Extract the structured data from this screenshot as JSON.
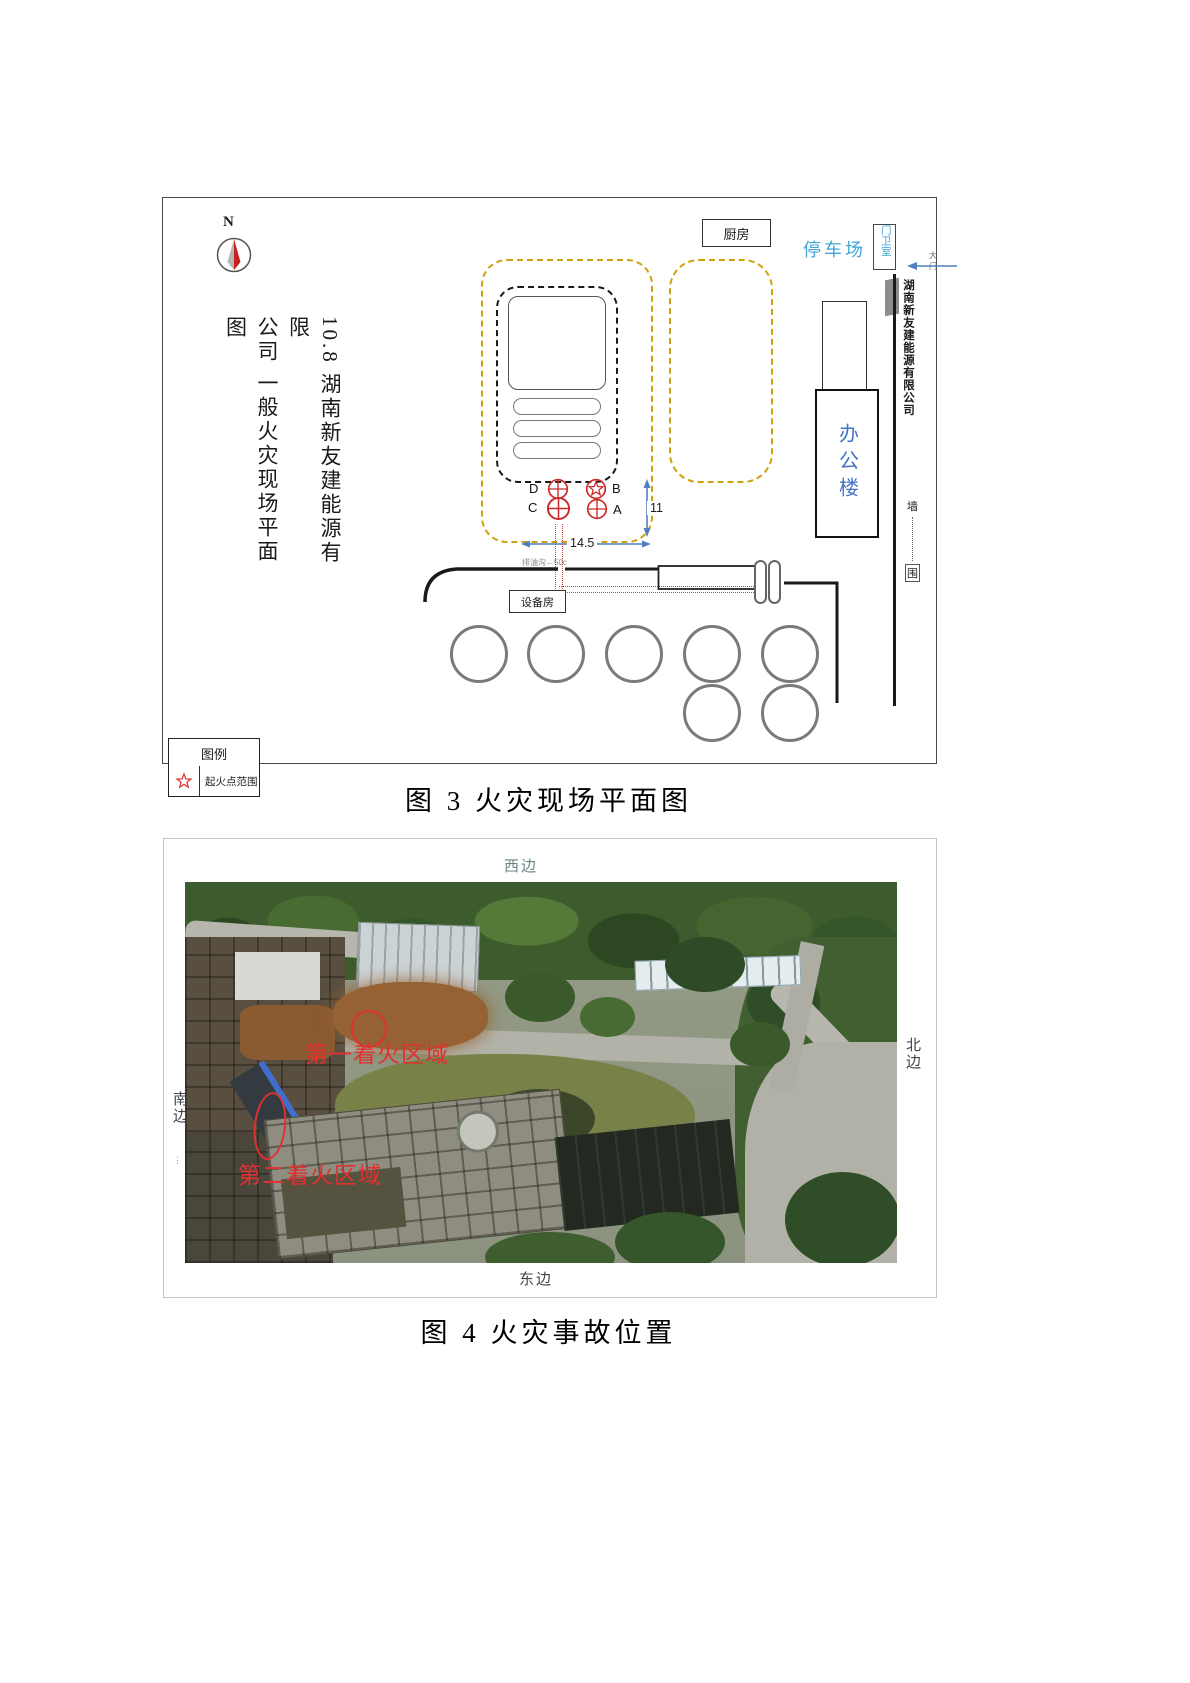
{
  "figure3": {
    "caption": "图 3 火灾现场平面图",
    "compass": "N",
    "title_right_column": "10.8 湖南新友建能源有限",
    "title_left_column": "公司 一般火灾现场平面图",
    "kitchen": "厨房",
    "parking": "停车场",
    "gatehouse": "门卫室",
    "gate_note": "大门",
    "boundary_company_name": "湖南新友建能源有限公司",
    "office_building": "办公楼",
    "fence_char_top": "墙",
    "fence_char_bottom": "围",
    "equipment_room": "设备房",
    "oil_ditch_note": "排油沟←50c",
    "dim_width": "14.5",
    "dim_height": "11",
    "markers": {
      "d": "D",
      "b": "B",
      "c": "C",
      "a": "A"
    },
    "legend_title": "图例",
    "legend_item": "起火点范围"
  },
  "figure4": {
    "caption": "图 4 火灾事故位置",
    "west": "西边",
    "south": "南边",
    "north": "北边",
    "east": "东边",
    "fire_area_1": "第一着火区域",
    "fire_area_2": "第二着火区域"
  },
  "colors": {
    "boundary_yellow": "#cfa10e",
    "marker_red": "#cc2a2a",
    "annotation_red": "#e23030",
    "dimension_blue": "#4f81bd",
    "cyan_label_blue": "#42a5d5",
    "office_blue": "#4472c4"
  }
}
